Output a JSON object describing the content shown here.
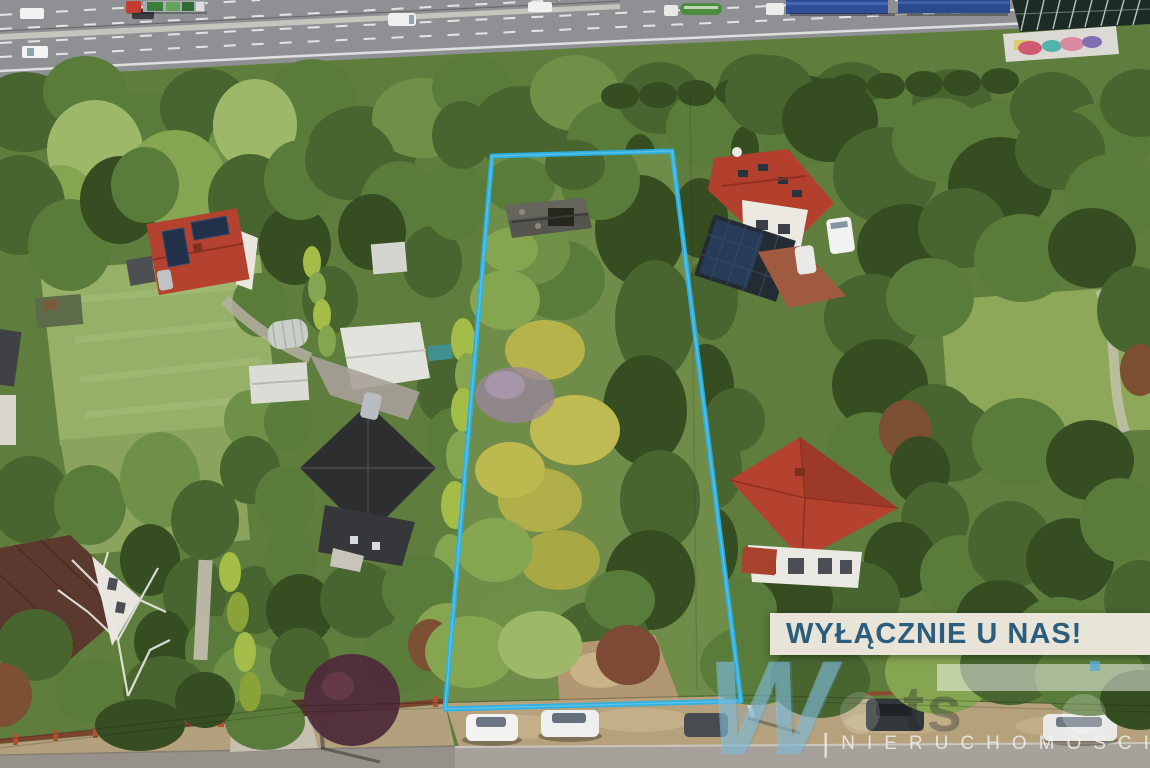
{
  "plot_outline": {
    "points": "492,156 672,151 741,701 445,709",
    "color": "#2bb1e7"
  },
  "banner": {
    "label": "WYŁĄCZNIE U NAS!",
    "background_color": "#e8e4d7",
    "text_color": "#2b5e7e"
  },
  "watermark": {
    "logo_letter": "W",
    "ghost_letters": "ts",
    "separator": "|",
    "label": "NIERUCHOMOŚCI"
  }
}
